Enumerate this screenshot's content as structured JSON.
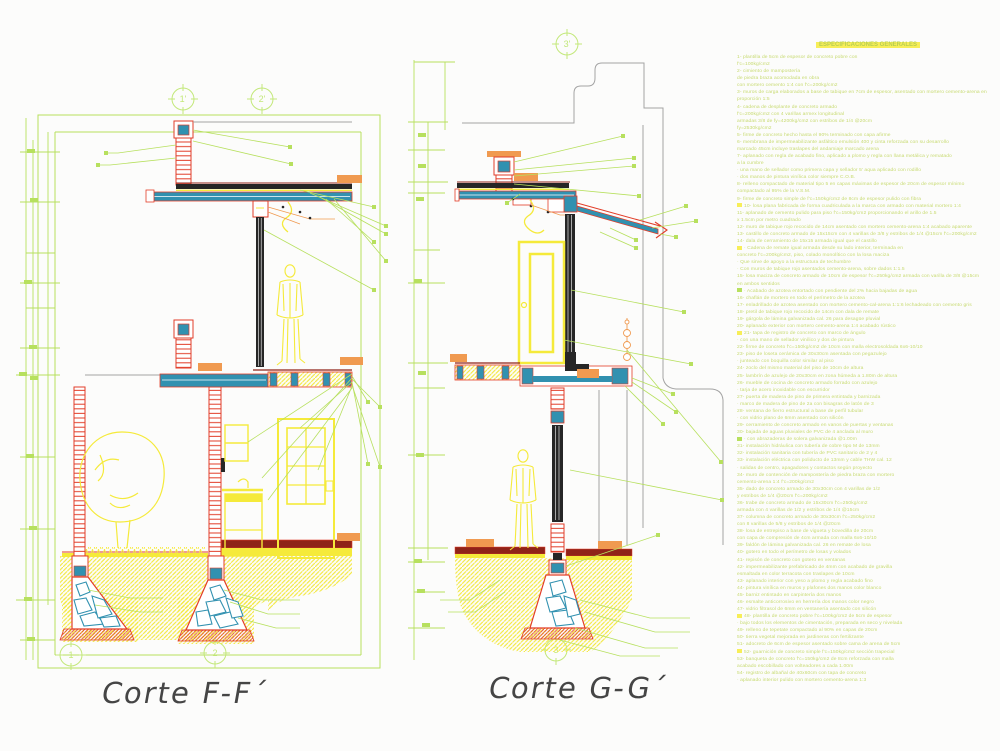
{
  "palette": {
    "green_lines": "#b7e05e",
    "yellow": "#f5ea3a",
    "cyan": "#3191b0",
    "red": "#e23d28",
    "orange": "#f09a50",
    "dark": "#262626",
    "dark_red": "#8f2318",
    "gray": "#a3a3a3",
    "title_text": "#454545",
    "spec_text": "#c7da70"
  },
  "sections": {
    "ff": {
      "title": "Corte F-F´",
      "axes_top": [
        {
          "label": "1'"
        },
        {
          "label": "2'"
        }
      ],
      "axes_bottom": [
        {
          "label": "1"
        },
        {
          "label": "2"
        }
      ]
    },
    "gg": {
      "title": "Corte G-G´",
      "axis_top": "3'",
      "axis_bottom": "3"
    }
  },
  "specs": {
    "title": "ESPECIFICACIONES GENERALES",
    "lines": [
      {
        "t": "1- plantilla de 5cm de espesor de concreto pobre con"
      },
      {
        "t": "f'c=100kg/cm2"
      },
      {
        "t": "2- cimiento de mampostería"
      },
      {
        "t": "de piedra braza acomodada en obra"
      },
      {
        "t": "con mortero cemento 1:4 con f'c=200kg/cm2"
      },
      {
        "t": "3- muros de carga elaborados a base de tabique en 7cm de espesor, asentado con mortero cemento-arena en"
      },
      {
        "t": "proporción 1:5"
      },
      {
        "t": "4- cadena de desplante de concreto armado"
      },
      {
        "t": "f'c=200kg/cm2 con 4 varillas armex longitudinal"
      },
      {
        "t": "armadas 3/8 de fy=4200kg/cm2 con estribos de 1/4 @20cm"
      },
      {
        "t": "fy=2530kg/cm2"
      },
      {
        "t": "5- firme de concreto hecho hasta el 90% terminado con capa afirme"
      },
      {
        "t": "6- membrana de impermeabilizante asfáltico emulsión 400 y cinta reforzada con su desarrollo"
      },
      {
        "t": "marcado 45cm incluye traslapes del andamiaje marcado arena"
      },
      {
        "t": "7- aplanado con regla de acabado fino, aplicado a plomo y regla con llana metálica y rematado"
      },
      {
        "t": "a la cumbre"
      },
      {
        "t": "· una mano de sellador como primera capa y sellador 5' aqua aplicado con rodillo"
      },
      {
        "t": "· dos manos de pintura vinílica color siempre C.O.B."
      },
      {
        "t": "8- relleno compactado de material tipo 5 en capas máximas de espesor de 20cm de espesor mínimo"
      },
      {
        "t": "compactado al 95% de la V.S.M."
      },
      {
        "t": "9- firme de concreto simple de f'c=150kg/cm2 de 8cm de espesor pulido con fibra"
      },
      {
        "t": "10- losa plana fabricada de forma cuadriculada a la marca con armado con material mortero 1:4",
        "c": "y"
      },
      {
        "t": "11- aplanado de cemento pulido para piso f'c=150kg/cm2 proporcionando el arillo de 1.5"
      },
      {
        "t": "x 1.5cm por metro cuadrado"
      },
      {
        "t": "12- muro de tabique rojo recocido de 14cm asentado con mortero cemento-arena 1:4 acabado aparente"
      },
      {
        "t": "13- castillo de concreto armado de 15x15cm con 4 varillas de 3/8 y estribos de 1/4 @15cm f'c=200kg/cm2"
      },
      {
        "t": "14- dala de cerramiento de 15x15 armada igual que el castillo"
      },
      {
        "t": "· Cadena de remate igual armada desde su lado interior, terminada en",
        "c": "y"
      },
      {
        "t": "concreto f'c=200kg/cm2, piso, colado monolítico con la losa maciza"
      },
      {
        "t": "· Que sirve de apoyo a la estructura de techumbre"
      },
      {
        "t": "· Con muros de tabique rojo asentados cemento-arena, sobre dados 1:1.5"
      },
      {
        "t": "15- losa maciza de concreto armado de 10cm de espesor f'c=250kg/cm2 armada con varilla de 3/8 @15cm"
      },
      {
        "t": "en ambos sentidos"
      },
      {
        "t": "· Acabado de azotea entortado con pendiente del 2% hacia bajadas de agua",
        "c": "g"
      },
      {
        "t": "16- chaflán de mortero en todo el perímetro de la azotea"
      },
      {
        "t": "17- enladrillado de azotea asentado con mortero cemento-cal-arena 1:1:6 lechadeado con cemento gris"
      },
      {
        "t": "18- pretil de tabique rojo recocido de 14cm con dala de remate"
      },
      {
        "t": "19- gárgola de lámina galvanizada cal. 26 para desagüe pluvial"
      },
      {
        "t": "20- aplanado exterior con mortero cemento-arena 1:4 acabado rústico"
      },
      {
        "t": "21- tapa de registro de concreto con marco de ángulo",
        "c": "y"
      },
      {
        "t": "· con una mano de sellador vinílico y dos de pintura"
      },
      {
        "t": "22- firme de concreto f'c=150kg/cm2 de 10cm con malla electrosoldada 6x6-10/10"
      },
      {
        "t": "23- piso de loseta cerámica de 30x30cm asentada con pegazulejo"
      },
      {
        "t": "· junteado con boquilla color similar al piso"
      },
      {
        "t": "24- zoclo del mismo material del piso de 10cm de altura"
      },
      {
        "t": "25- lambrín de azulejo de 20x30cm en zona húmeda a 1.80m de altura"
      },
      {
        "t": "26- mueble de cocina de concreto armado forrado con azulejo"
      },
      {
        "t": "· tarja de acero inoxidable con escurridor"
      },
      {
        "t": "27- puerta de madera de pino de primera entintada y barnizada"
      },
      {
        "t": "· marco de madera de pino de 2a con bisagras de latón de 3"
      },
      {
        "t": "28- ventana de fierro estructural a base de perfil tubular"
      },
      {
        "t": "· con vidrio plano de 6mm asentado con silicón"
      },
      {
        "t": "29- cerramiento de concreto armado en vanos de puertas y ventanas"
      },
      {
        "t": "30- bajada de aguas pluviales de PVC de 4 anclada al muro"
      },
      {
        "t": "· con abrazaderas de solera galvanizada @1.00m",
        "c": "g"
      },
      {
        "t": "31- instalación hidráulica con tubería de cobre tipo M de 13mm"
      },
      {
        "t": "32- instalación sanitaria con tubería de PVC sanitario de 2 y 4"
      },
      {
        "t": "33- instalación eléctrica con poliducto de 13mm y cable THW cal. 12"
      },
      {
        "t": "· salidas de centro, apagadores y contactos según proyecto"
      },
      {
        "t": "34- muro de contención de mampostería de piedra braza con mortero"
      },
      {
        "t": "cemento-arena 1:4 f'c=200kg/cm2"
      },
      {
        "t": "35- dado de concreto armado de 30x30cm con 4 varillas de 1/2"
      },
      {
        "t": "y estribos de 1/4 @20cm f'c=200kg/cm2"
      },
      {
        "t": "36- trabe de concreto armado de 15x30cm f'c=250kg/cm2"
      },
      {
        "t": "armada con 4 varillas de 1/2 y estribos de 1/4 @15cm"
      },
      {
        "t": "37- columna de concreto armado de 30x30cm f'c=250kg/cm2"
      },
      {
        "t": "con 8 varillas de 5/8 y estribos de 1/4 @20cm"
      },
      {
        "t": "38- losa de entrepiso a base de vigueta y bovedilla de 20cm"
      },
      {
        "t": "con capa de compresión de 4cm armada con malla 6x6-10/10"
      },
      {
        "t": "39- faldón de lámina galvanizada cal. 26 en remate de losa"
      },
      {
        "t": "40- gotero en todo el perímetro de losas y volados"
      },
      {
        "t": "41- repisón de concreto con gotero en ventanas"
      },
      {
        "t": "42- impermeabilizante prefabricado de 4mm con acabado de gravilla"
      },
      {
        "t": "esmaltada en color terracota con traslapes de 10cm"
      },
      {
        "t": "43- aplanado interior con yeso a plomo y regla acabado fino"
      },
      {
        "t": "44- pintura vinílica en muros y plafones dos manos color blanco"
      },
      {
        "t": "45- barniz entintado en carpintería dos manos"
      },
      {
        "t": "46- esmalte anticorrosivo en herrería dos manos color negro"
      },
      {
        "t": "47- vidrio filtrasol de 6mm en ventanería asentado con silicón"
      },
      {
        "t": "48- plantilla de concreto pobre f'c=100kg/cm2 de 5cm de espesor",
        "c": "y"
      },
      {
        "t": "· bajo todos los elementos de cimentación, preparada en seco y nivelada"
      },
      {
        "t": "49- relleno de tepetate compactado al 90% en capas de 20cm"
      },
      {
        "t": "50- tierra vegetal mejorada en jardineras con fertilizante"
      },
      {
        "t": "51- adocreto de 6cm de espesor asentado sobre cama de arena de 5cm"
      },
      {
        "t": "52- guarnición de concreto simple f'c=150kg/cm2 sección trapecial",
        "c": "y"
      },
      {
        "t": "53- banqueta de concreto f'c=150kg/cm2 de 8cm reforzada con malla"
      },
      {
        "t": "acabado escobillado con volteadores a cada 1.00m"
      },
      {
        "t": "54- registro de albañal de 40x60cm con tapa de concreto"
      },
      {
        "t": "· aplanado interior pulido con mortero cemento-arena 1:3"
      }
    ]
  }
}
